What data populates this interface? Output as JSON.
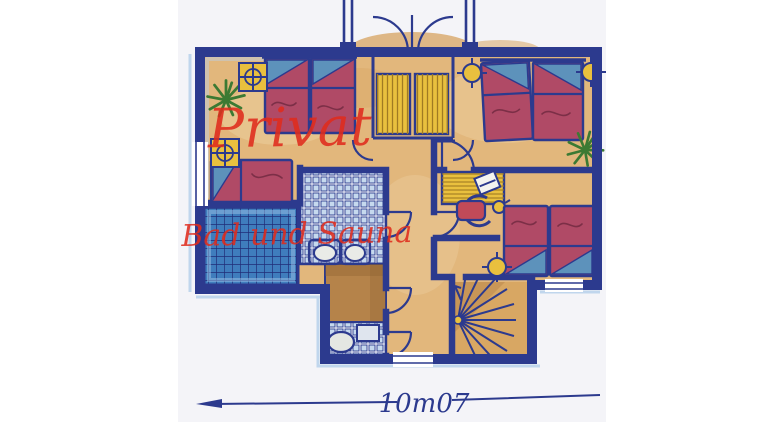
{
  "labels": {
    "private_area": "Privat",
    "bath_area": "Bad und Sauna",
    "dimension": "10m07"
  },
  "fixtures": {
    "beds": "bed-icon",
    "entrance": "double-door-icon",
    "stairs": "spiral-staircase-icon",
    "bath": "sink-icon",
    "wc": "toilet-icon",
    "office": "desk-icon",
    "lighting": "ceiling-light-icon",
    "decor": "plant-icon"
  },
  "colors": {
    "wall": "#2c3a8e",
    "floor": "#e2b77c",
    "floor_light": "#f0d7ab",
    "floor_dark": "#d49c55",
    "bed": "#b04a66",
    "bed_dark": "#7c2f47",
    "pillow": "#5d92bb",
    "wood": "#e9c03e",
    "wood_stripe": "#a07a22",
    "tile_light_cell": "#c6d9ee",
    "tile_dark": "#3f7dbd",
    "tile_dark_line": "#202d78",
    "sauna_glow": "#9cc2e6",
    "brown": "#b5834a",
    "brown_dark": "#8a5f2e",
    "plant": "#3c7a33",
    "red": "#df2b1c",
    "chair": "#c14a58",
    "stairs": "#d8a763",
    "paper": "#f4f4f8",
    "white": "#ffffff"
  }
}
